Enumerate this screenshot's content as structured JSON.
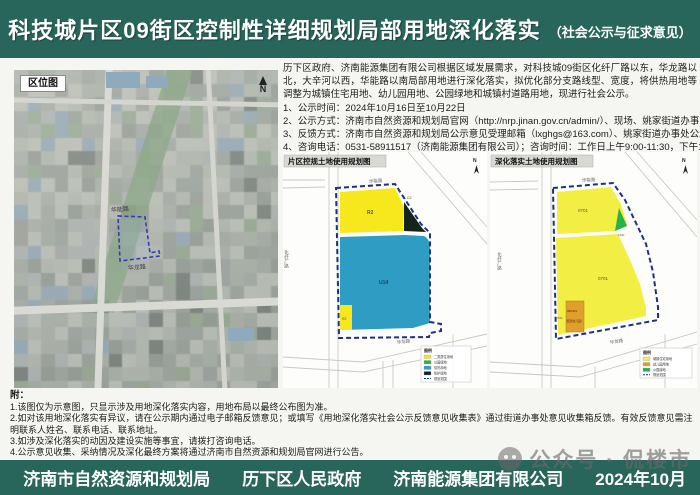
{
  "header": {
    "title": "科技城片区09街区控制性详细规划局部用地深化落实",
    "subtitle": "（社会公示与征求意见）"
  },
  "intro": "历下区政府、济南能源集团有限公司根据区域发展需求，对科技城09街区化纤厂路以东，华龙路以北，大辛河以西，华能路以南局部用地进行深化落实，拟优化部分支路线型、宽度，将供热用地等调整为城镇住宅用地、幼儿园用地、公园绿地和城镇村道路用地，现进行社会公示。",
  "items": [
    "1、公示时间：2024年10月16日至10月22日",
    "2、公示方式：济南市自然资源和规划局官网（http://nrp.jinan.gov.cn/admin/）、现场、姚家街道办事处。",
    "3、反馈方式：济南市自然资源和规划局公示意见受理邮箱（lxghgs@163.com）、姚家街道办事处公示意见收集箱",
    "4、咨询电话：0531-58911517（济南能源集团有限公司）；咨询时间：工作日上午9:00-11:30，下午13:30-17:00。"
  ],
  "location_map": {
    "label": "区位图",
    "north": "N",
    "road_top": "华能路",
    "road_bottom": "华龙路"
  },
  "left_map": {
    "title": "片区控规土地使用规划图",
    "north": "N",
    "parcel_labels": [
      "R2",
      "G2",
      "U14",
      "R2"
    ],
    "roads": {
      "top": "华能路",
      "left": "化纤厂路",
      "bottom": "华龙路"
    },
    "legend": {
      "title": "图例",
      "items": [
        {
          "label": "二类居住用地",
          "color": "#f6e81c"
        },
        {
          "label": "公园绿地",
          "color": "#27b24a"
        },
        {
          "label": "供热用地",
          "color": "#2f9cc4"
        },
        {
          "label": "防护绿地",
          "color": "#15241a"
        },
        {
          "label": "规划范围",
          "color": "dashed"
        }
      ]
    }
  },
  "right_map": {
    "title": "深化落实土地使用规划图",
    "north": "N",
    "parcel_labels": [
      "0701",
      "1401",
      "0701",
      "0701",
      "080404",
      "(配建幼儿园)"
    ],
    "roads": {
      "top": "华能路",
      "left": "化纤厂路",
      "bottom": "华龙路"
    },
    "legend": {
      "title": "图例",
      "items": [
        {
          "label": "城镇住宅用地",
          "color": "#f2ee44"
        },
        {
          "label": "幼儿园用地",
          "color": "#e09f2d"
        },
        {
          "label": "公园绿地",
          "color": "#27b24a"
        },
        {
          "label": "规划范围",
          "color": "dashed"
        }
      ]
    }
  },
  "notes": {
    "label": "附：",
    "lines": [
      "1.该图仅为示意图，只显示涉及用地深化落实内容，用地布局以最终公布图为准。",
      "2.如对该用地深化落实有异议，请在公示期内通过电子邮箱反馈意见；或填写《用地深化落实社会公示反馈意见收集表》通过街道办事处意见收集箱反馈。有效反馈意见需注明联系人姓名、联系电话、联系地址。",
      "3.如涉及深化落实的动因及建设实施等事宜，请拨打咨询电话。",
      "4.公示意见收集、采纳情况及深化最终方案将通过济南市自然资源和规划局官网进行公告。"
    ]
  },
  "watermark": "公众号 · 侃楼市",
  "footer": {
    "orgs": [
      "济南市自然资源和规划局",
      "历下区人民政府",
      "济南能源集团有限公司"
    ],
    "date": "2024年10月"
  },
  "colors": {
    "bar_green": "#28655a",
    "boundary_navy": "#1d2f86",
    "parcel_yellow_left": "#f6e81c",
    "parcel_yellow_right": "#f2ee44",
    "parcel_blue": "#2f9cc4",
    "parcel_green": "#27b24a",
    "parcel_orange": "#e09f2d",
    "parcel_dark": "#15241a"
  }
}
